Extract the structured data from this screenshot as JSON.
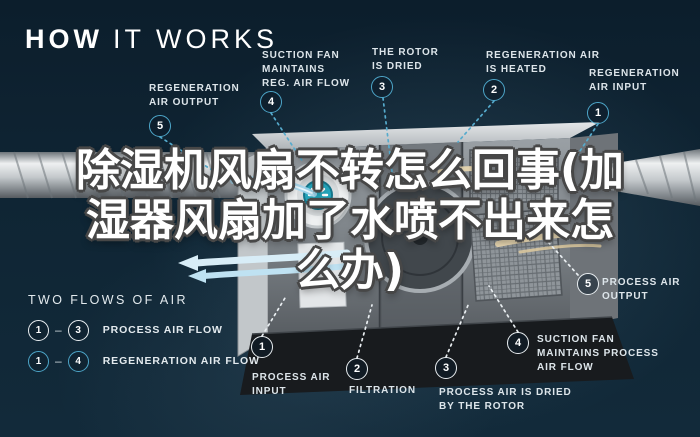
{
  "title": {
    "word_bold": "HOW",
    "word_light": "IT WORKS"
  },
  "headline": {
    "line1": "除湿机风扇不转怎么回事(加",
    "line2": "湿器风扇加了水喷不出来怎",
    "line3": "么办)"
  },
  "callouts": {
    "regen_output": {
      "num": "5",
      "line1": "REGENERATION",
      "line2": "AIR OUTPUT"
    },
    "suction_reg": {
      "num": "4",
      "line1": "SUCTION FAN",
      "line2": "MAINTAINS",
      "line3": "REG. AIR FLOW"
    },
    "rotor_dried": {
      "num": "3",
      "line1": "THE ROTOR",
      "line2": "IS DRIED"
    },
    "regen_heated": {
      "num": "2",
      "line1": "REGENERATION AIR",
      "line2": "IS HEATED"
    },
    "regen_input": {
      "num": "1",
      "line1": "REGENERATION",
      "line2": "AIR INPUT"
    },
    "process_input": {
      "num": "1",
      "line1": "PROCESS AIR",
      "line2": "INPUT"
    },
    "filtration": {
      "num": "2",
      "line1": "FILTRATION"
    },
    "process_dried": {
      "num": "3",
      "line1": "PROCESS AIR IS DRIED",
      "line2": "BY THE ROTOR"
    },
    "suction_process": {
      "num": "4",
      "line1": "SUCTION FAN",
      "line2": "MAINTAINS PROCESS",
      "line3": "AIR FLOW"
    },
    "process_output": {
      "num": "5",
      "line1": "PROCESS AIR",
      "line2": "OUTPUT"
    }
  },
  "legend": {
    "title": "TWO FLOWS OF AIR",
    "rows": [
      {
        "from": "1",
        "to": "3",
        "label": "PROCESS AIR FLOW"
      },
      {
        "from": "1",
        "to": "4",
        "label": "REGENERATION AIR FLOW"
      }
    ],
    "dash": "–"
  },
  "colors": {
    "background": "#0f2534",
    "regeneration_blue": "#4da6c9",
    "process_white": "#e9eef1",
    "heated_air_tan": "#e9d8b2"
  }
}
